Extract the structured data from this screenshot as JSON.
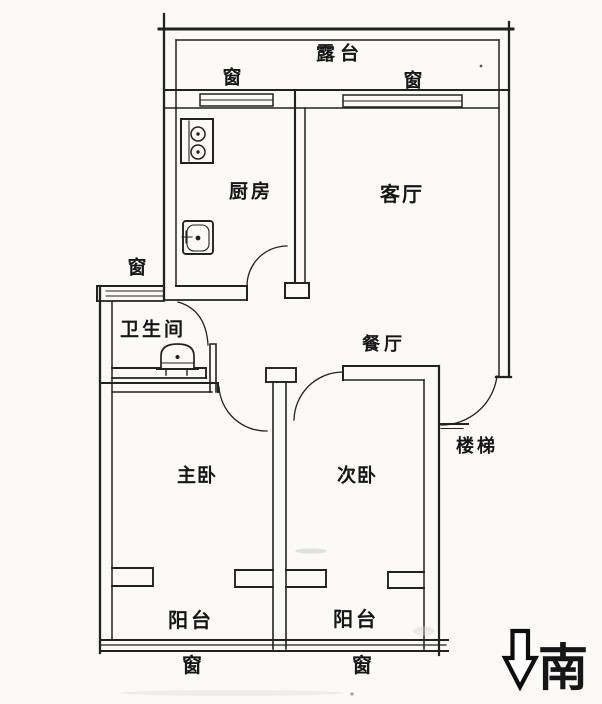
{
  "rooms": {
    "terrace": "露台",
    "kitchen": "厨房",
    "living_room": "客厅",
    "bathroom": "卫生间",
    "dining_room": "餐厅",
    "stairs": "楼梯",
    "master_bedroom": "主卧",
    "second_bedroom": "次卧",
    "balcony_left": "阳台",
    "balcony_right": "阳台"
  },
  "windows": {
    "kitchen_top": "窗",
    "living_top": "窗",
    "bathroom_left": "窗",
    "balcony_left_bottom": "窗",
    "balcony_right_bottom": "窗"
  },
  "fixtures": {
    "stove_icon": "two-burner-stove",
    "sink_icon": "kitchen-sink",
    "toilet_icon": "toilet"
  },
  "compass": {
    "south": "南",
    "arrow_icon": "hollow-down-arrow"
  },
  "colors": {
    "line": "#222222",
    "background": "#fbfaf7"
  }
}
